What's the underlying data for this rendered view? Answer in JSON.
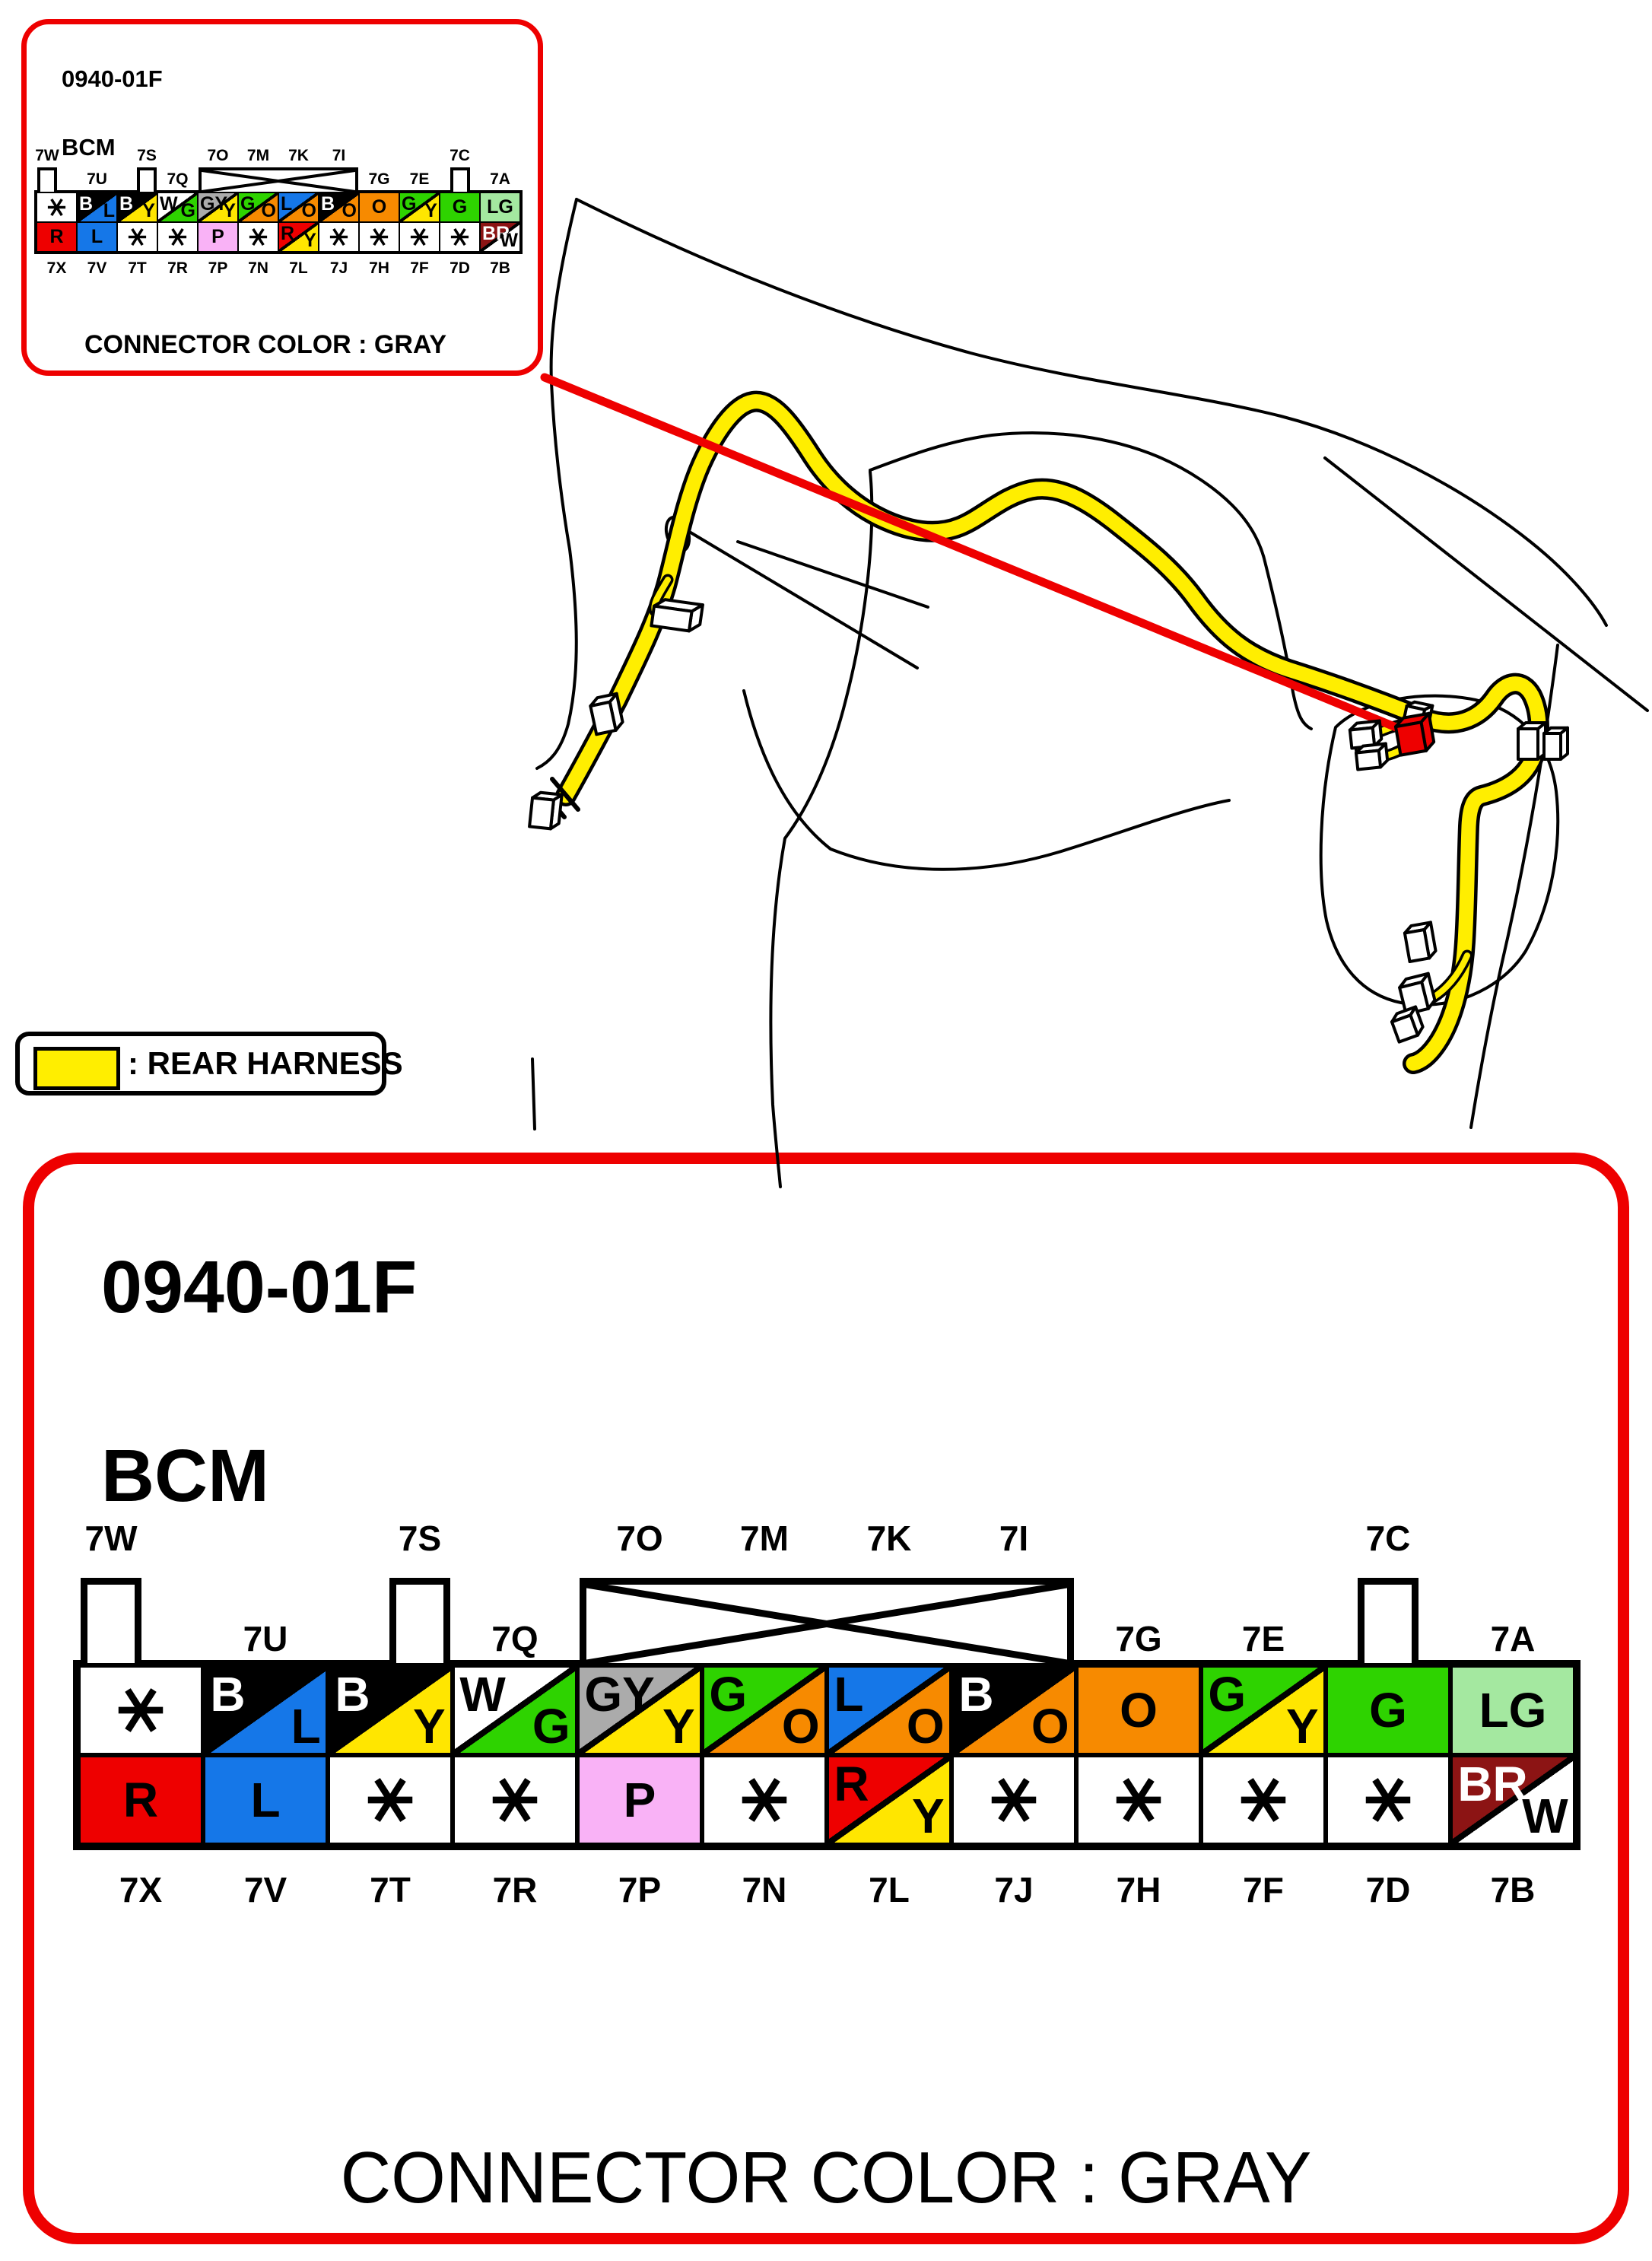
{
  "inset": {
    "id_code": "0940-01F",
    "module": "BCM",
    "footer": "CONNECTOR COLOR : GRAY"
  },
  "main_panel": {
    "id_code": "0940-01F",
    "module": "BCM",
    "footer": "CONNECTOR COLOR : GRAY"
  },
  "legend": {
    "label": ": REAR HARNESS"
  },
  "connector": {
    "tabs": [
      {
        "col": 1,
        "align": "left",
        "label": "7W"
      },
      {
        "col": 3,
        "align": "right",
        "label": "7S"
      },
      {
        "col": 11,
        "align": "center",
        "label": "7C"
      }
    ],
    "crossed": {
      "from": 5,
      "to": 8,
      "labels": [
        {
          "col": 5,
          "text": "7O"
        },
        {
          "col": 6,
          "text": "7M"
        },
        {
          "col": 7,
          "text": "7K"
        },
        {
          "col": 8,
          "text": "7I"
        }
      ]
    },
    "row2_labels": [
      {
        "col": 2,
        "text": "7U"
      },
      {
        "col": 4,
        "text": "7Q"
      },
      {
        "col": 9,
        "text": "7G"
      },
      {
        "col": 10,
        "text": "7E"
      },
      {
        "col": 12,
        "text": "7A"
      }
    ],
    "bottom_labels": [
      "7X",
      "7V",
      "7T",
      "7R",
      "7P",
      "7N",
      "7L",
      "7J",
      "7H",
      "7F",
      "7D",
      "7B"
    ],
    "top_row": [
      {
        "star": true
      },
      {
        "split": [
          "B",
          "L"
        ]
      },
      {
        "split": [
          "B",
          "Y"
        ]
      },
      {
        "split": [
          "W",
          "G"
        ]
      },
      {
        "split": [
          "GY",
          "Y"
        ]
      },
      {
        "split": [
          "G",
          "O"
        ]
      },
      {
        "split": [
          "L",
          "O"
        ]
      },
      {
        "split": [
          "B",
          "O"
        ]
      },
      {
        "solid": "O"
      },
      {
        "split": [
          "G",
          "Y"
        ]
      },
      {
        "solid": "G"
      },
      {
        "solid": "LG"
      }
    ],
    "bottom_row": [
      {
        "solid": "R"
      },
      {
        "solid": "L"
      },
      {
        "star": true
      },
      {
        "star": true
      },
      {
        "solid": "P"
      },
      {
        "star": true
      },
      {
        "split": [
          "R",
          "Y"
        ]
      },
      {
        "star": true
      },
      {
        "star": true
      },
      {
        "star": true
      },
      {
        "star": true
      },
      {
        "split": [
          "BR",
          "W"
        ]
      }
    ]
  },
  "wire_colors": {
    "B": "#000000",
    "L": "#1577E8",
    "Y": "#FFE600",
    "W": "#FFFFFF",
    "G": "#2ED300",
    "GY": "#ABABAB",
    "O": "#F78A00",
    "R": "#EE0000",
    "P": "#F9B2F6",
    "LG": "#A4E8A0",
    "BR": "#8C1414"
  },
  "white_letter_codes": [
    "B",
    "BR"
  ],
  "accents": {
    "panel_border_red": "#EE0000",
    "callout_red": "#EE0000",
    "harness_yellow": "#FFEE00",
    "line_black": "#000000"
  }
}
